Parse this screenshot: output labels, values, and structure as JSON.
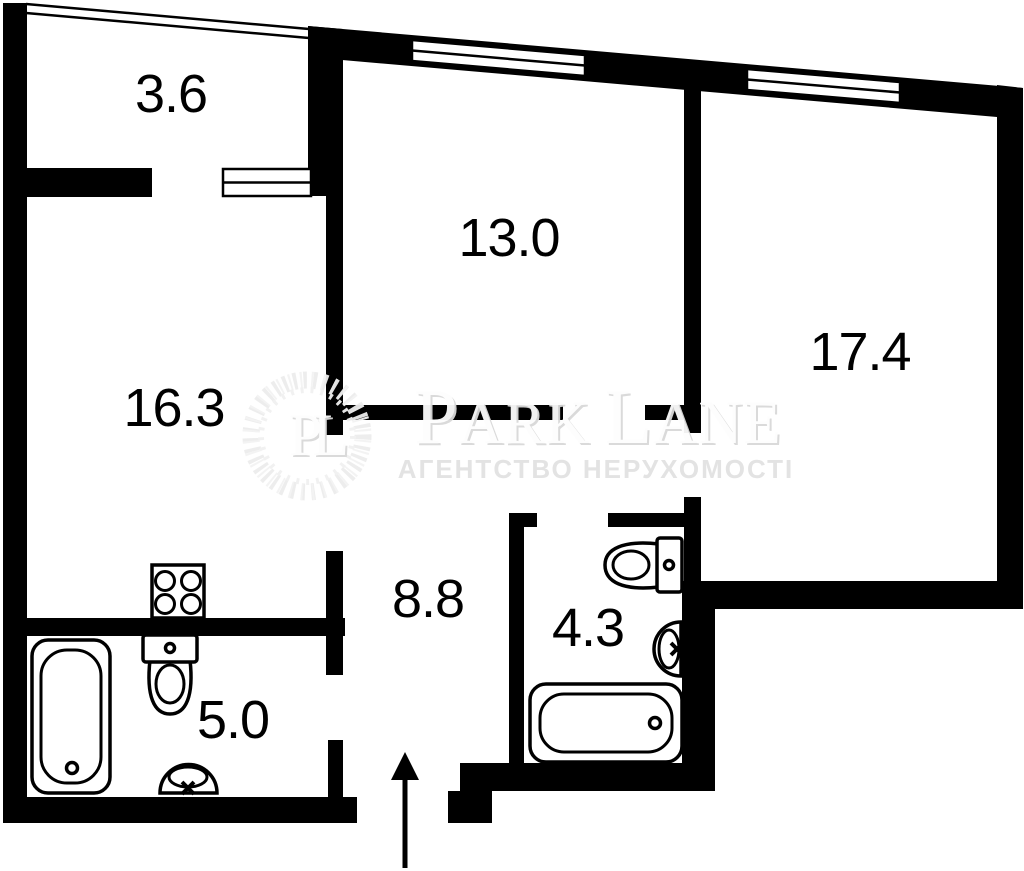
{
  "floor_plan": {
    "rooms": [
      {
        "id": "balcony_top_left",
        "area": "3.6"
      },
      {
        "id": "room_top_middle",
        "area": "13.0"
      },
      {
        "id": "room_right",
        "area": "17.4"
      },
      {
        "id": "room_left",
        "area": "16.3"
      },
      {
        "id": "hallway",
        "area": "8.8"
      },
      {
        "id": "bathroom_left",
        "area": "5.0"
      },
      {
        "id": "bathroom_center",
        "area": "4.3"
      }
    ],
    "fixtures": [
      {
        "icon": "stove-icon",
        "room": "16.3"
      },
      {
        "icon": "bathtub-icon",
        "room": "5.0"
      },
      {
        "icon": "toilet-icon",
        "room": "5.0"
      },
      {
        "icon": "sink-icon",
        "room": "5.0"
      },
      {
        "icon": "toilet-icon",
        "room": "4.3"
      },
      {
        "icon": "sink-icon",
        "room": "4.3"
      },
      {
        "icon": "bathtub-icon",
        "room": "4.3"
      },
      {
        "icon": "entrance-arrow-icon",
        "room": "entrance"
      }
    ],
    "watermark": {
      "monogram": "PL",
      "brand": {
        "full": "PARK LANE",
        "part1_initial": "P",
        "part1_rest": "ARK",
        "part2_initial": "L",
        "part2_rest": "ANE"
      },
      "tagline": "АГЕНТСТВО НЕРУХОМОСТІ"
    },
    "colors": {
      "wall": "#000000",
      "background": "#ffffff",
      "label": "#000000",
      "watermark_text": "#fdfdfd",
      "watermark_shadow": "#d9d9d9",
      "watermark_ring": "#ededed",
      "tagline_fill": "#e2e2e2"
    }
  }
}
